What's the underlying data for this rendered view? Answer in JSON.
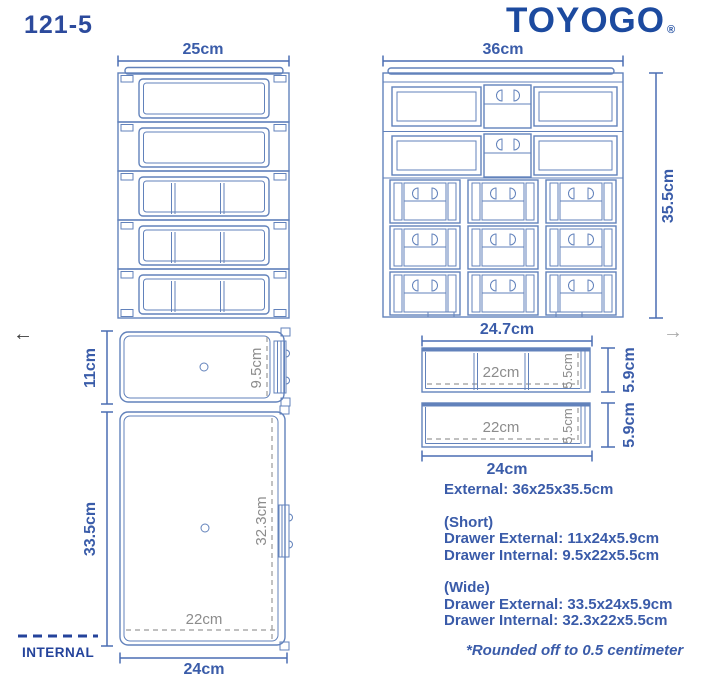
{
  "header": {
    "model": "121-5",
    "brand": "TOYOGO",
    "registered_mark": "®"
  },
  "gallery_nav": {
    "prev": "←",
    "next": "→"
  },
  "cabinet_side_view": {
    "width": "25cm"
  },
  "cabinet_front_view": {
    "width": "36cm",
    "height": "35.5cm"
  },
  "short_drawer_top_view": {
    "external_depth": "11cm",
    "internal_depth": "9.5cm"
  },
  "wide_drawer_top_view": {
    "external_depth": "33.5cm",
    "internal_depth": "32.3cm",
    "internal_width": "22cm",
    "external_width": "24cm"
  },
  "internal_legend": {
    "label": "INTERNAL"
  },
  "short_drawer_front_view": {
    "external_width": "24.7cm",
    "internal_width": "22cm",
    "internal_height": "5.5cm",
    "external_height": "5.9cm"
  },
  "wide_drawer_front_view": {
    "internal_width": "22cm",
    "internal_height": "5.5cm",
    "external_height": "5.9cm",
    "external_width": "24cm"
  },
  "specs": {
    "external": "External: 36x25x35.5cm",
    "short_title": "(Short)",
    "short_drawer_external": "Drawer External: 11x24x5.9cm",
    "short_drawer_internal": "Drawer Internal: 9.5x22x5.5cm",
    "wide_title": "(Wide)",
    "wide_drawer_external": "Drawer External: 33.5x24x5.9cm",
    "wide_drawer_internal": "Drawer Internal: 32.3x22x5.5cm",
    "footnote": "*Rounded off to 0.5 centimeter"
  },
  "colors": {
    "outline_blue": "#6282bb",
    "dimension_blue": "#3a5ca9",
    "brand_navy": "#1c4a9f",
    "model_navy": "#2c4a9c",
    "internal_gray": "#8c8c8c"
  }
}
